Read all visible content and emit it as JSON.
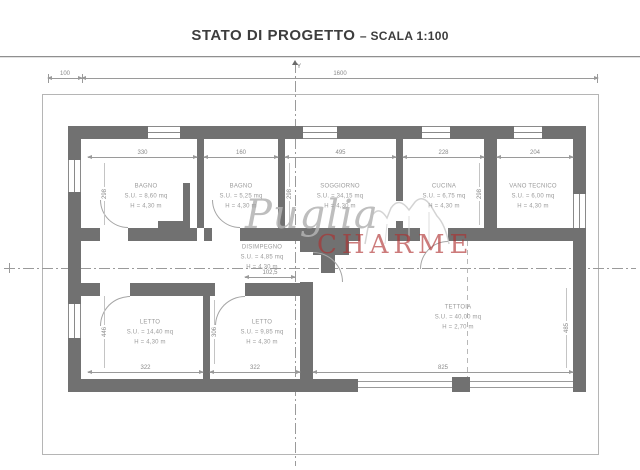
{
  "title": {
    "main": "STATO DI PROGETTO",
    "scale": "– SCALA 1:100"
  },
  "axis": {
    "y": "Y"
  },
  "watermark": {
    "script": "Puglia",
    "caps": "CHARME"
  },
  "colors": {
    "wall": "#717171",
    "line": "#9a9a9a",
    "label": "#9b9b9b",
    "charme_red": "#af3030"
  },
  "rooms": [
    {
      "name": "BAGNO",
      "su": "S.U. = 8,60 mq",
      "h": "H = 4,30 m"
    },
    {
      "name": "BAGNO",
      "su": "S.U. = 5,25 mq",
      "h": "H = 4,30 m"
    },
    {
      "name": "SOGGIORNO",
      "su": "S.U. = 34,15 mq",
      "h": "H = 4,30 m"
    },
    {
      "name": "CUCINA",
      "su": "S.U. = 6,75 mq",
      "h": "H = 4,30 m"
    },
    {
      "name": "VANO TECNICO",
      "su": "S.U. = 6,00 mq",
      "h": "H = 4,30 m"
    },
    {
      "name": "DISIMPEGNO",
      "su": "S.U. = 4,85 mq",
      "h": "H = 4,30 m"
    },
    {
      "name": "LETTO",
      "su": "S.U. = 14,40 mq",
      "h": "H = 4,30 m"
    },
    {
      "name": "LETTO",
      "su": "S.U. = 9,85 mq",
      "h": "H = 4,30 m"
    },
    {
      "name": "TETTOIA",
      "su": "S.U. = 40,00 mq",
      "h": "H = 2,70 m"
    }
  ],
  "dims": {
    "top": [
      "100",
      "1600"
    ],
    "widths": [
      "330",
      "160",
      "495",
      "228",
      "204"
    ],
    "bottoms": [
      "322",
      "322",
      "825"
    ],
    "inner": "102,5",
    "verticals": [
      "298",
      "298",
      "298",
      "446",
      "306",
      "485"
    ]
  }
}
